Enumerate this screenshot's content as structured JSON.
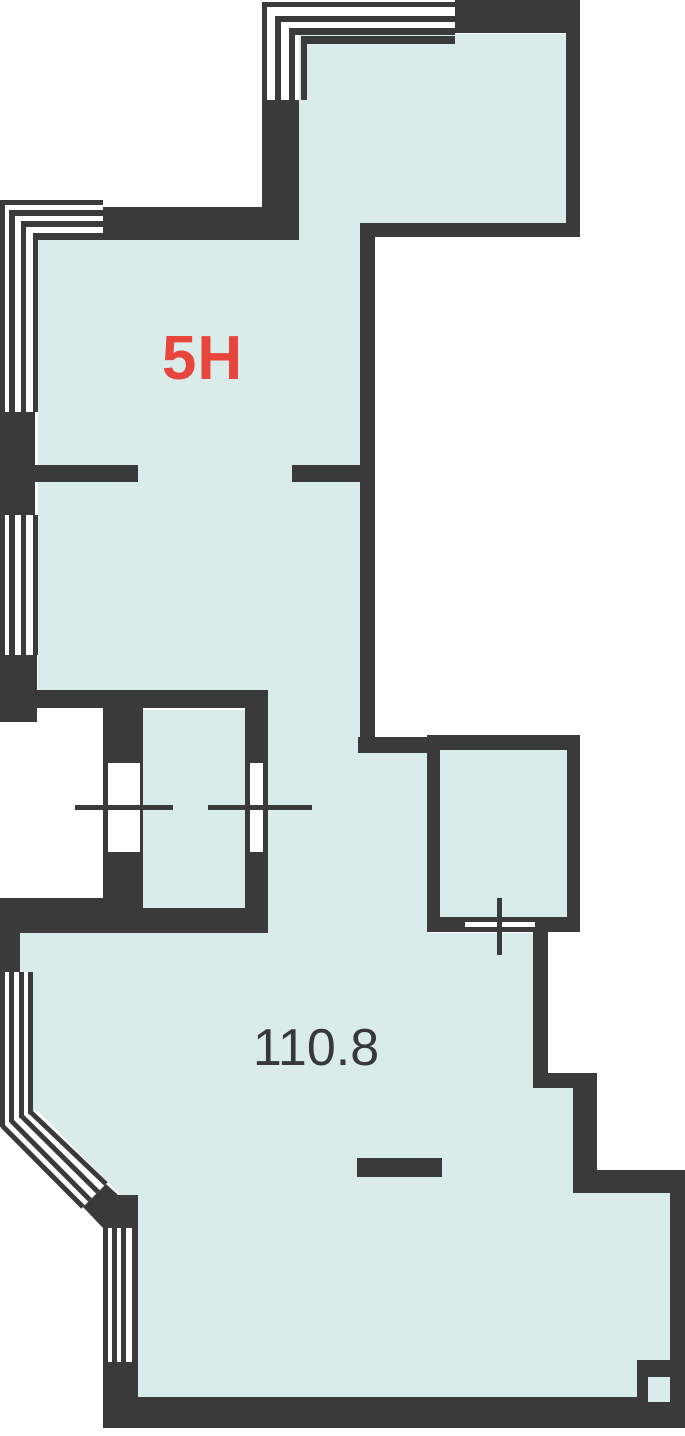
{
  "plan": {
    "unit_label": "5H",
    "area_value": "110.8"
  },
  "colors": {
    "wall": "#3a3a3a",
    "floor": "#d9ecea",
    "unit_label": "#e8453c",
    "area_text": "#383838",
    "background": "#ffffff"
  }
}
